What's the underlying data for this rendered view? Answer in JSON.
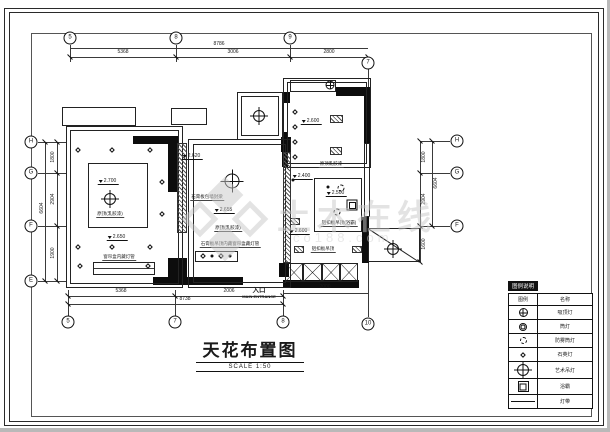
{
  "title_block": {
    "title": "天花布置图",
    "scale": "SCALE 1:50"
  },
  "entrance": {
    "label_cn": "入口",
    "label_en": "MAIN ENTRANCE"
  },
  "watermark": {
    "brand": "土木在线",
    "domain": "co188.com"
  },
  "colors": {
    "line": "#1a1a1a",
    "wall": "#0d0d0d",
    "watermark": "#c9c9c9"
  },
  "legend": {
    "title": "图例说明",
    "headers": {
      "symbol": "图例",
      "name": "名称"
    },
    "rows": [
      {
        "sym": "ceiling",
        "icon": "ceiling-lamp-icon",
        "name": "吸顶灯"
      },
      {
        "sym": "downlight",
        "icon": "downlight-icon",
        "name": "筒灯"
      },
      {
        "sym": "dashlight",
        "icon": "moistureproof-downlight-icon",
        "name": "防雾筒灯"
      },
      {
        "sym": "diamond",
        "icon": "quartz-lamp-icon",
        "name": "石英灯"
      },
      {
        "sym": "chandelier",
        "icon": "chandelier-icon",
        "name": "艺术吊灯"
      },
      {
        "sym": "bathheater",
        "icon": "bath-heater-icon",
        "name": "浴霸"
      },
      {
        "sym": "strip",
        "icon": "light-strip-icon",
        "name": "灯带"
      }
    ]
  },
  "grid_bubbles": [
    {
      "label": "5",
      "x": 70,
      "y": 38
    },
    {
      "label": "8",
      "x": 176,
      "y": 38
    },
    {
      "label": "9",
      "x": 290,
      "y": 38
    },
    {
      "label": "7",
      "x": 368,
      "y": 63
    },
    {
      "label": "5",
      "x": 68,
      "y": 322
    },
    {
      "label": "7",
      "x": 175,
      "y": 322
    },
    {
      "label": "8",
      "x": 283,
      "y": 322
    },
    {
      "label": "10",
      "x": 368,
      "y": 324
    },
    {
      "label": "H",
      "x": 31,
      "y": 142
    },
    {
      "label": "G",
      "x": 31,
      "y": 173
    },
    {
      "label": "F",
      "x": 31,
      "y": 226
    },
    {
      "label": "E",
      "x": 31,
      "y": 281
    },
    {
      "label": "H",
      "x": 457,
      "y": 141
    },
    {
      "label": "G",
      "x": 457,
      "y": 173
    },
    {
      "label": "F",
      "x": 457,
      "y": 226
    }
  ],
  "dimensions": [
    {
      "t": "8786",
      "x": 219,
      "y": 44
    },
    {
      "t": "5368",
      "x": 123,
      "y": 52
    },
    {
      "t": "3006",
      "x": 233,
      "y": 52
    },
    {
      "t": "2800",
      "x": 329,
      "y": 52
    },
    {
      "t": "5368",
      "x": 121,
      "y": 291
    },
    {
      "t": "2006",
      "x": 229,
      "y": 291
    },
    {
      "t": "8738",
      "x": 185,
      "y": 299
    },
    {
      "t": "2000",
      "x": 325,
      "y": 287
    },
    {
      "t": "1800",
      "x": 53,
      "y": 157,
      "rot": true
    },
    {
      "t": "2904",
      "x": 53,
      "y": 199,
      "rot": true
    },
    {
      "t": "1900",
      "x": 53,
      "y": 253,
      "rot": true
    },
    {
      "t": "6604",
      "x": 42,
      "y": 208,
      "rot": true
    },
    {
      "t": "1800",
      "x": 424,
      "y": 157,
      "rot": true
    },
    {
      "t": "2904",
      "x": 424,
      "y": 199,
      "rot": true
    },
    {
      "t": "6604",
      "x": 436,
      "y": 183,
      "rot": true
    },
    {
      "t": "1600",
      "x": 424,
      "y": 244,
      "rot": true
    }
  ],
  "elevations": [
    {
      "v": "2.700",
      "x": 108,
      "y": 178
    },
    {
      "v": "2.650",
      "x": 117,
      "y": 234
    },
    {
      "v": "2.620",
      "x": 192,
      "y": 153
    },
    {
      "v": "2.655",
      "x": 224,
      "y": 207
    },
    {
      "v": "2.600",
      "x": 311,
      "y": 118
    },
    {
      "v": "2.400",
      "x": 302,
      "y": 173
    },
    {
      "v": "2.500",
      "x": 336,
      "y": 190
    },
    {
      "v": "2.600",
      "x": 299,
      "y": 228
    }
  ],
  "plan_labels": [
    {
      "t": "原顶(乳胶漆)",
      "x": 110,
      "y": 211
    },
    {
      "t": "窗帘盒内藏灯管",
      "x": 119,
      "y": 254
    },
    {
      "t": "石膏板包墙封梁",
      "x": 207,
      "y": 194
    },
    {
      "t": "原顶(乳胶漆)",
      "x": 228,
      "y": 225
    },
    {
      "t": "石膏板吊顶内藏窗帘盒藏灯管",
      "x": 230,
      "y": 241
    },
    {
      "t": "原顶乳胶漆",
      "x": 331,
      "y": 161
    },
    {
      "t": "铝扣板吊顶(浴霸)",
      "x": 339,
      "y": 220
    },
    {
      "t": "铝扣板吊顶",
      "x": 323,
      "y": 246
    }
  ],
  "symbols": [
    {
      "k": "chandelier",
      "x": 110,
      "y": 199
    },
    {
      "k": "chandelier-lg",
      "x": 232,
      "y": 181
    },
    {
      "k": "chandelier",
      "x": 259,
      "y": 116
    },
    {
      "k": "ceiling",
      "x": 330,
      "y": 85
    },
    {
      "k": "chandelier",
      "x": 393,
      "y": 249
    },
    {
      "k": "diamond",
      "x": 78,
      "y": 150
    },
    {
      "k": "diamond",
      "x": 112,
      "y": 150
    },
    {
      "k": "diamond",
      "x": 150,
      "y": 150
    },
    {
      "k": "diamond",
      "x": 162,
      "y": 182
    },
    {
      "k": "diamond",
      "x": 162,
      "y": 214
    },
    {
      "k": "diamond",
      "x": 78,
      "y": 247
    },
    {
      "k": "diamond",
      "x": 112,
      "y": 247
    },
    {
      "k": "diamond",
      "x": 150,
      "y": 247
    },
    {
      "k": "diamond",
      "x": 80,
      "y": 266
    },
    {
      "k": "diamond",
      "x": 148,
      "y": 266
    },
    {
      "k": "diamond",
      "x": 295,
      "y": 112
    },
    {
      "k": "diamond",
      "x": 295,
      "y": 127
    },
    {
      "k": "diamond",
      "x": 295,
      "y": 142
    },
    {
      "k": "diamond",
      "x": 295,
      "y": 157
    },
    {
      "k": "diamond",
      "x": 203,
      "y": 256
    },
    {
      "k": "dot",
      "x": 212,
      "y": 256
    },
    {
      "k": "diamond",
      "x": 221,
      "y": 256
    },
    {
      "k": "dot",
      "x": 230,
      "y": 256
    },
    {
      "k": "dot",
      "x": 328,
      "y": 187
    },
    {
      "k": "dashlight",
      "x": 341,
      "y": 188
    },
    {
      "k": "dashlight",
      "x": 337,
      "y": 212
    },
    {
      "k": "bathheater",
      "x": 352,
      "y": 205
    },
    {
      "k": "dot",
      "x": 293,
      "y": 180
    }
  ],
  "geometry": {
    "walls": [
      [
        133,
        136,
        45,
        8
      ],
      [
        168,
        136,
        9,
        56
      ],
      [
        168,
        258,
        19,
        20
      ],
      [
        153,
        277,
        90,
        8
      ],
      [
        281,
        137,
        10,
        15
      ],
      [
        279,
        263,
        10,
        14
      ],
      [
        336,
        87,
        35,
        9
      ],
      [
        364,
        95,
        7,
        48
      ],
      [
        362,
        217,
        7,
        46
      ],
      [
        283,
        280,
        76,
        8
      ],
      [
        283,
        92,
        7,
        11
      ],
      [
        282,
        132,
        6,
        35
      ]
    ],
    "thin_rects": [
      [
        66,
        126,
        117,
        162
      ],
      [
        70,
        130,
        109,
        154
      ],
      [
        62,
        107,
        74,
        19
      ],
      [
        171,
        108,
        36,
        17
      ],
      [
        188,
        139,
        103,
        149
      ],
      [
        193,
        144,
        93,
        139
      ],
      [
        237,
        92,
        46,
        48
      ],
      [
        241,
        96,
        38,
        40
      ],
      [
        283,
        78,
        88,
        90
      ],
      [
        287,
        82,
        80,
        82
      ],
      [
        290,
        80,
        46,
        12
      ],
      [
        314,
        178,
        48,
        54
      ],
      [
        368,
        228,
        52,
        34
      ],
      [
        88,
        163,
        60,
        65
      ],
      [
        93,
        262,
        62,
        13
      ],
      [
        195,
        251,
        43,
        11
      ],
      [
        364,
        143,
        6,
        74
      ]
    ],
    "hatches": [
      [
        177,
        143,
        10,
        90
      ],
      [
        283,
        152,
        8,
        111
      ],
      [
        330,
        115,
        13,
        8
      ],
      [
        330,
        147,
        12,
        8
      ],
      [
        290,
        218,
        10,
        7
      ],
      [
        294,
        246,
        10,
        7
      ],
      [
        352,
        246,
        10,
        7
      ]
    ],
    "lines": [
      [
        70,
        48,
        298,
        1
      ],
      [
        70,
        57,
        298,
        1
      ],
      [
        70,
        45,
        1,
        17
      ],
      [
        176,
        45,
        1,
        17
      ],
      [
        290,
        45,
        1,
        17
      ],
      [
        368,
        69,
        1,
        23
      ],
      [
        68,
        296,
        215,
        1
      ],
      [
        68,
        304,
        215,
        1
      ],
      [
        68,
        290,
        1,
        26
      ],
      [
        175,
        290,
        1,
        26
      ],
      [
        283,
        290,
        1,
        26
      ],
      [
        368,
        262,
        1,
        55
      ],
      [
        283,
        293,
        85,
        1
      ],
      [
        38,
        142,
        28,
        1
      ],
      [
        38,
        173,
        28,
        1
      ],
      [
        38,
        226,
        28,
        1
      ],
      [
        38,
        281,
        28,
        1
      ],
      [
        45,
        142,
        1,
        139
      ],
      [
        57,
        142,
        1,
        139
      ],
      [
        420,
        141,
        30,
        1
      ],
      [
        420,
        173,
        30,
        1
      ],
      [
        420,
        226,
        30,
        1
      ],
      [
        420,
        141,
        1,
        121
      ],
      [
        432,
        141,
        1,
        85
      ],
      [
        93,
        268,
        62,
        1
      ],
      [
        291,
        167,
        73,
        1
      ]
    ],
    "ticks": [
      [
        70,
        57
      ],
      [
        176,
        57
      ],
      [
        290,
        57
      ],
      [
        368,
        57
      ],
      [
        68,
        296
      ],
      [
        175,
        296
      ],
      [
        283,
        296
      ],
      [
        68,
        304
      ],
      [
        283,
        304
      ],
      [
        57,
        142
      ],
      [
        57,
        173
      ],
      [
        57,
        226
      ],
      [
        57,
        281
      ],
      [
        45,
        142
      ],
      [
        45,
        281
      ],
      [
        420,
        141
      ],
      [
        420,
        173
      ],
      [
        420,
        226
      ],
      [
        420,
        262
      ],
      [
        432,
        141
      ],
      [
        432,
        226
      ]
    ],
    "xpanels": {
      "x": 285,
      "y": 263,
      "w": 73,
      "h": 19,
      "n": 4
    },
    "diagonal": {
      "x": 368,
      "y": 228,
      "len": 62,
      "angle": 33.2
    }
  }
}
